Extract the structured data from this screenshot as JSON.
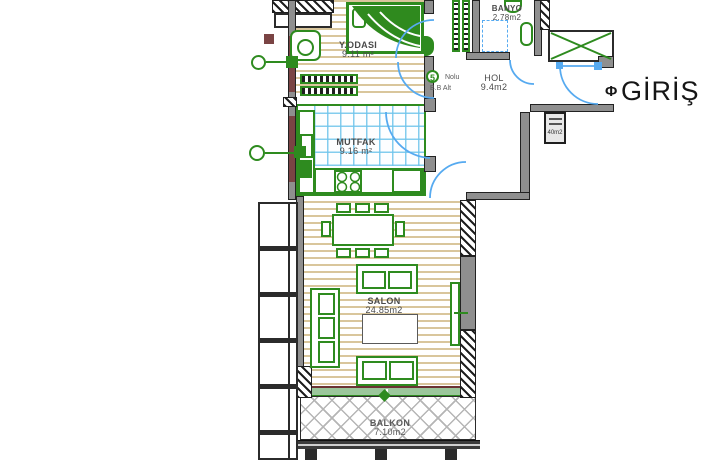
{
  "plan": {
    "entrance_label": "GİRİŞ",
    "entrance_symbol": "Φ",
    "unit_marker": {
      "number": "5",
      "line1": "Nolu",
      "line2": "B.B Alt"
    },
    "shaft_label": "40m2",
    "rooms": {
      "bedroom": {
        "name": "Y.ODASI",
        "area": "9.11 m²"
      },
      "kitchen": {
        "name": "MUTFAK",
        "area": "9.16 m²"
      },
      "hall": {
        "name": "HOL",
        "area": "9.4m2"
      },
      "bathroom": {
        "name": "BANYO",
        "area": "2.78m2"
      },
      "living": {
        "name": "SALON",
        "area": "24.85m2"
      },
      "balcony": {
        "name": "BALKON",
        "area": "7.10m2"
      }
    },
    "colors": {
      "furniture_green": "#2e8b1f",
      "door_blue": "#56aaf0",
      "floor_stripe": "#d9c69c",
      "tile_blue": "#7cc5e8",
      "wall_dark": "#2b2b2b",
      "wall_gray": "#8f8f8f",
      "accent_maroon": "#7a4444"
    }
  }
}
